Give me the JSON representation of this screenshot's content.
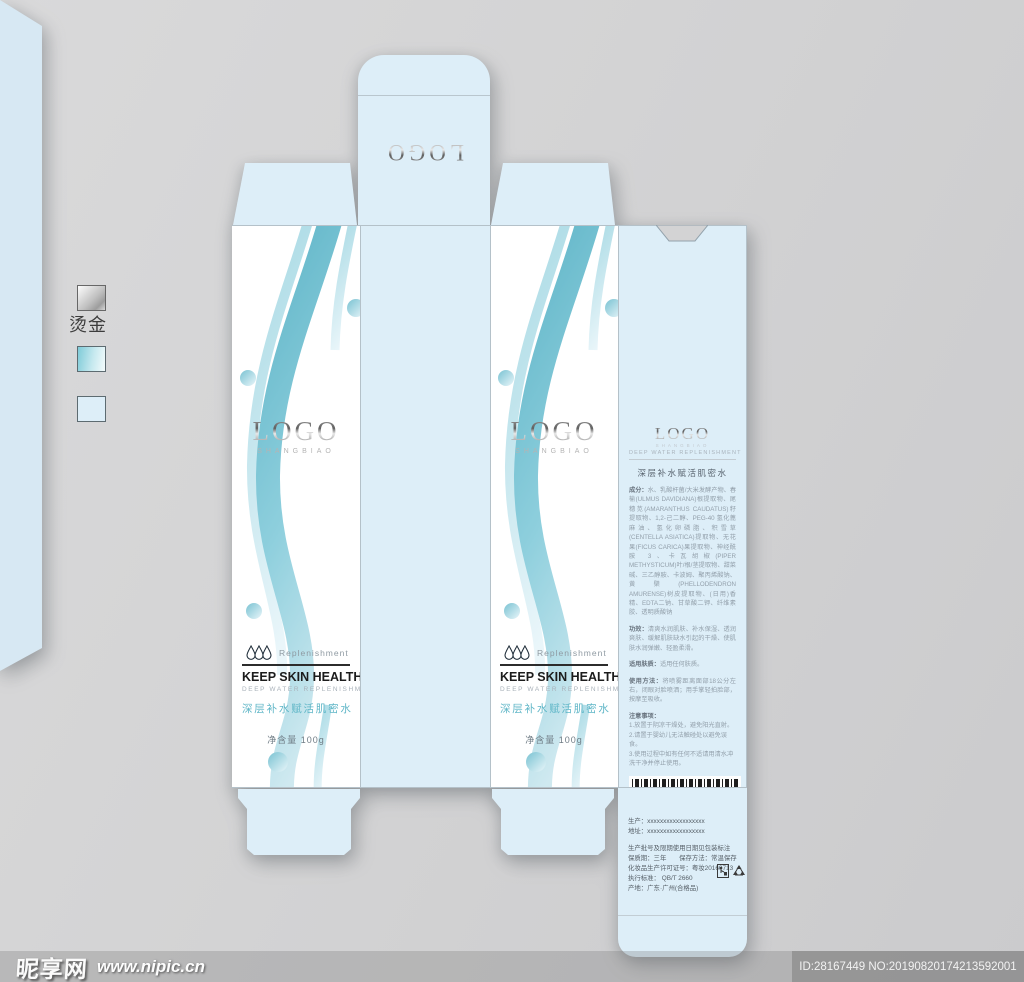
{
  "legend": {
    "hot_stamp_label": "烫金",
    "swatches": [
      {
        "name": "hot-stamp-silver",
        "color": "#c2c2c2"
      },
      {
        "name": "gradient-teal",
        "color": "#7ecbd8"
      },
      {
        "name": "panel-light-blue",
        "color": "#ddeef8"
      }
    ]
  },
  "colors": {
    "background": "#d3d3d4",
    "panel_blue": "#ddeef8",
    "wave_teal": "#6fbccd",
    "accent_teal_text": "#5fb6c7",
    "silver_logo": "#8b8b8b"
  },
  "brand": {
    "logo": "LOGO",
    "logo_sub": "SHANGBIAO"
  },
  "top_flap": {
    "logo": "LOGO"
  },
  "front_panel": {
    "replenishment": "Replenishment",
    "headline": "KEEP SKIN HEALTHY",
    "subhead": "DEEP WATER REPLENISHMENT",
    "product_cn": "深层补水赋活肌密水",
    "net_weight": "净含量 100g"
  },
  "info_panel": {
    "logo": "LOGO",
    "logo_sub": "SHANGBIAO",
    "subhead": "DEEP WATER REPLENISHMENT",
    "product_cn": "深层补水赋活肌密水",
    "sections": [
      {
        "label": "成分：",
        "text": "水、乳酸杆菌/大米发酵产物、春榆(ULMUS DAVIDIANA)根提取物、尾穗苋(AMARANTHUS CAUDATUS)籽提取物、1,2-己二醇、PEG-40 氢化蓖麻油、氢化卵磷脂、积雪草(CENTELLA ASIATICA)提取物、无花果(FICUS CARICA)果提取物、神经酰胺 3、卡瓦胡椒(PIPER METHYSTICUM)叶/根/茎提取物、甜菜碱、三乙醇胺、卡波姆、聚丙烯酸钠、黄檗(PHELLODENDRON AMURENSE)树皮提取物、(日用)香精、EDTA二钠、甘草酸二钾、纤维素胶、透明质酸钠"
      },
      {
        "label": "功效：",
        "text": "清爽水润肌肤、补水保湿、透润爽肤、缓解肌肤缺水引起的干燥、使肌肤水润弹嫩、轻盈柔滑。"
      },
      {
        "label": "适用肤质：",
        "text": "适用任何肤质。"
      },
      {
        "label": "使用方法：",
        "text": "将喷雾距离面部18公分左右，闭眼对脸喷洒；用手掌轻拍脸部，按摩至吸收。"
      }
    ],
    "notes_title": "注意事项：",
    "notes": [
      "1.放置于阴凉干燥处，避免阳光直射。",
      "2.请置于婴幼儿无法触碰处以避免误食。",
      "3.使用过程中如有任何不适请用清水冲洗干净并停止使用。"
    ],
    "barcode_digits": "6 924907 522912",
    "net_volume": "净含量:100ml"
  },
  "production_flap": {
    "producer": "生产：xxxxxxxxxxxxxxxxxx",
    "address": "地址：xxxxxxxxxxxxxxxxxx",
    "lines": [
      "生产批号及限期使用日期见包装标注",
      "保质期：三年　　保存方法：常温保存",
      "化妆品生产许可证号：粤妆20160713",
      "执行标准： QB/T 2660",
      "产地：广东·广州(合格品)"
    ]
  },
  "watermark": {
    "site": "昵享网",
    "url": "www.nipic.cn",
    "id_text": "ID:28167449 NO:20190820174213592001"
  }
}
